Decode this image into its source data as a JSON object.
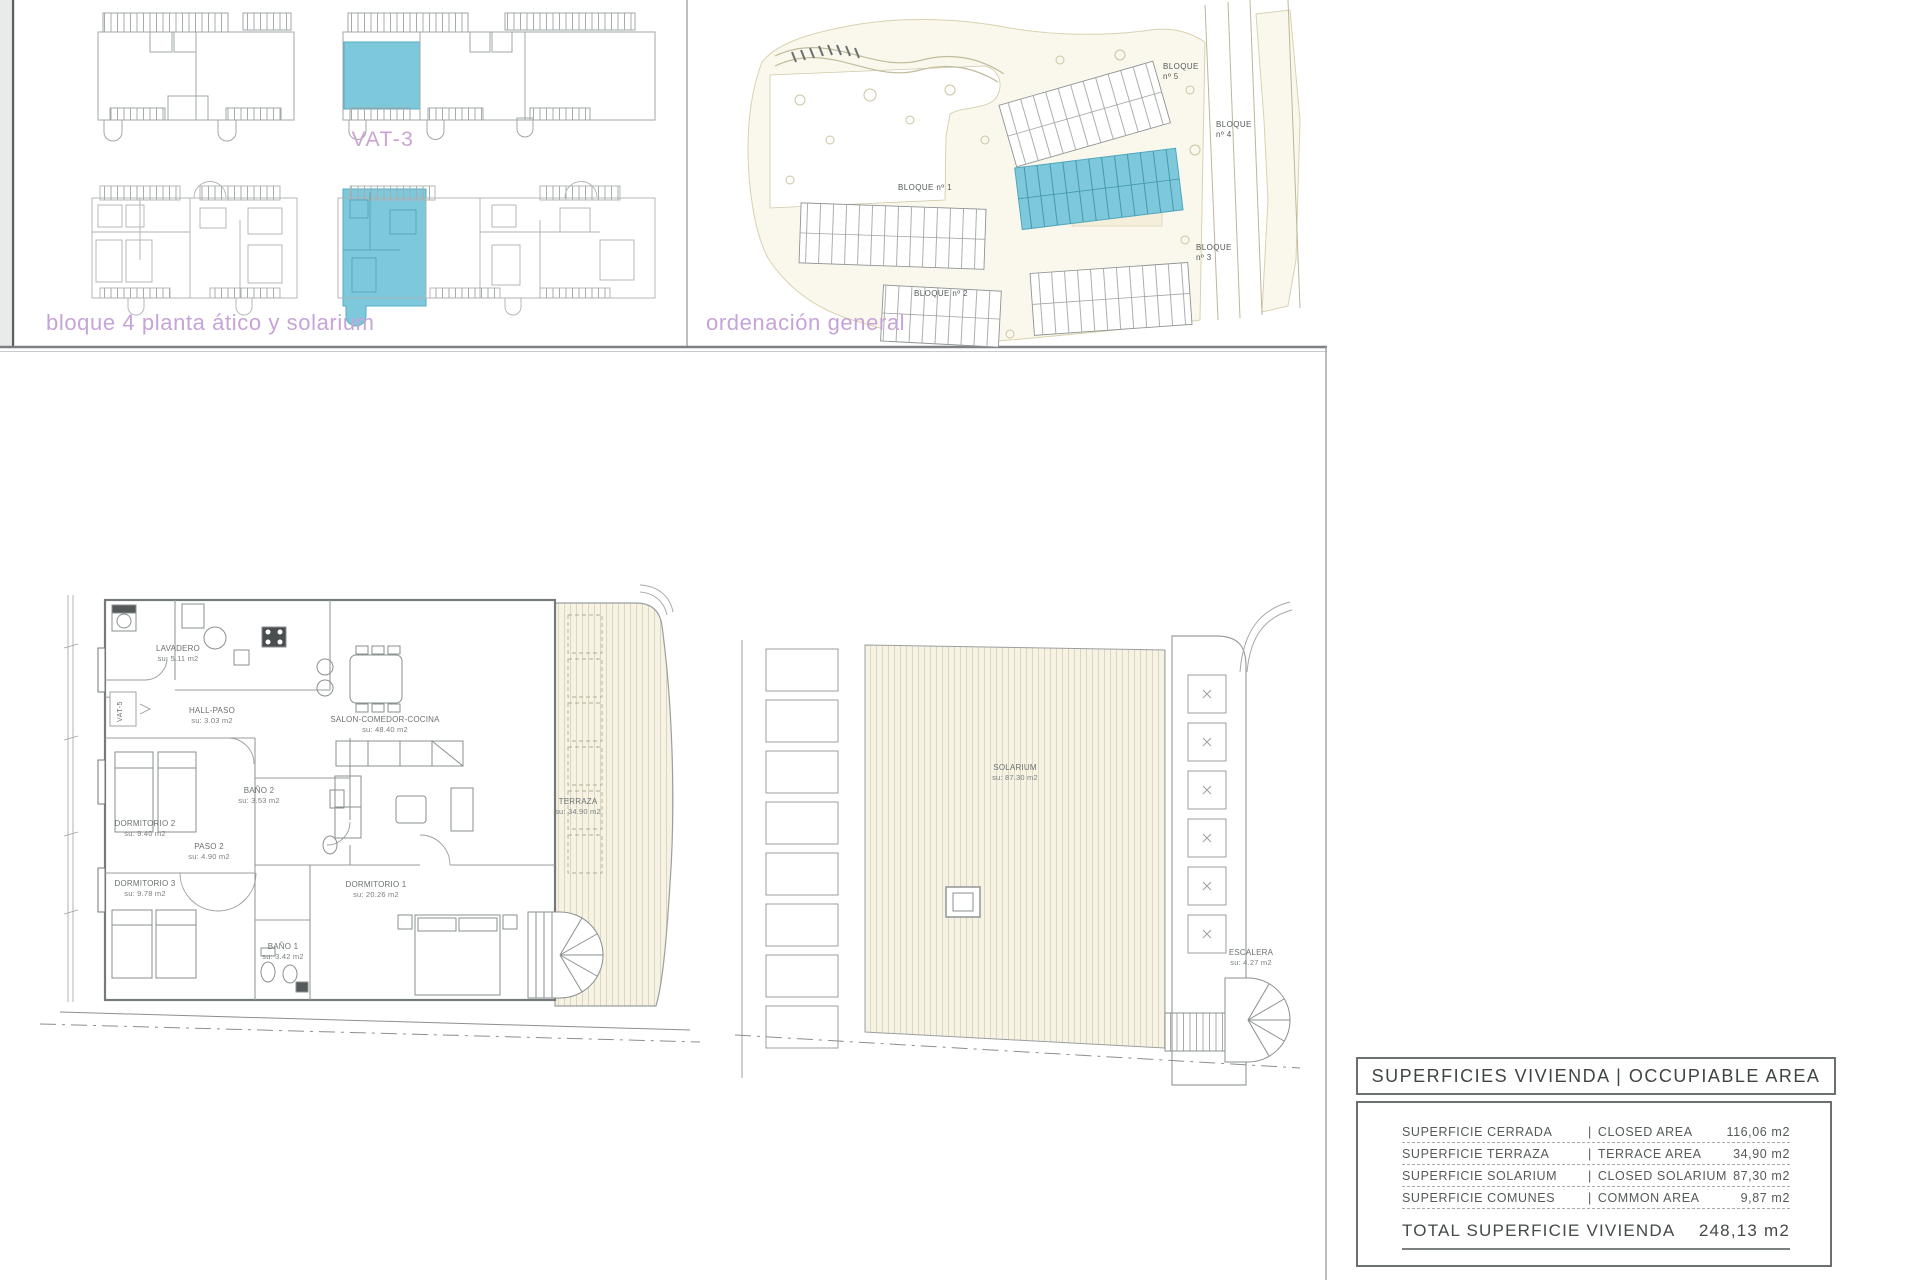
{
  "palette": {
    "highlight_teal": "#7dc8db",
    "teal_stroke": "#4fa6bd",
    "caption_purple": "#c6a4d7",
    "unit_purple": "#cba3d3",
    "line_gray": "#9b9fa0",
    "wall_gray": "#74797a",
    "text_gray": "#6b7071",
    "deck_fill": "#f6f3e5",
    "deck_stripe": "#dbd6bc",
    "site_fill": "#faf8ec",
    "pool_blue": "#a6e1f2"
  },
  "captions": {
    "block_plan": "bloque 4 planta ático y solarium",
    "site_plan": "ordenación general"
  },
  "unit_labels": {
    "vat3": "VAT-3",
    "vat5": "VAT-5"
  },
  "site_plan": {
    "blocks": {
      "b1": "BLOQUE nº 1",
      "b2": "BLOQUE nº 2",
      "b3": "BLOQUE\nnº 3",
      "b4": "BLOQUE\nnº 4",
      "b5": "BLOQUE\nnº 5"
    }
  },
  "floor_plan": {
    "rooms": {
      "lavadero": {
        "name": "LAVADERO",
        "area": "su: 5.11 m2"
      },
      "hall": {
        "name": "HALL-PASO",
        "area": "su: 3.03 m2"
      },
      "salon": {
        "name": "SALON-COMEDOR-COCINA",
        "area": "su: 48.40 m2"
      },
      "bano2": {
        "name": "BAÑO 2",
        "area": "su: 3.53 m2"
      },
      "dorm2": {
        "name": "DORMITORIO 2",
        "area": "su: 9.40 m2"
      },
      "paso2": {
        "name": "PASO 2",
        "area": "su: 4.90 m2"
      },
      "dorm3": {
        "name": "DORMITORIO 3",
        "area": "su: 9.78 m2"
      },
      "bano1": {
        "name": "BAÑO 1",
        "area": "su: 3.42 m2"
      },
      "dorm1": {
        "name": "DORMITORIO 1",
        "area": "su: 20.26 m2"
      },
      "terraza": {
        "name": "TERRAZA",
        "area": "su: 34.90 m2"
      }
    }
  },
  "solarium_plan": {
    "solarium": {
      "name": "SOLARIUM",
      "area": "su: 87.30 m2"
    },
    "escalera": {
      "name": "ESCALERA",
      "area": "su: 4.27 m2"
    }
  },
  "area_table": {
    "title": "SUPERFICIES VIVIENDA | OCCUPIABLE AREA",
    "separator": "|",
    "rows": [
      {
        "es": "SUPERFICIE CERRADA",
        "en": "CLOSED AREA",
        "value": "116,06 m2"
      },
      {
        "es": "SUPERFICIE TERRAZA",
        "en": "TERRACE AREA",
        "value": "34,90 m2"
      },
      {
        "es": "SUPERFICIE SOLARIUM",
        "en": "CLOSED SOLARIUM",
        "value": "87,30 m2"
      },
      {
        "es": "SUPERFICIE COMUNES",
        "en": "COMMON AREA",
        "value": "9,87 m2"
      }
    ],
    "total": {
      "label": "TOTAL SUPERFICIE VIVIENDA",
      "value": "248,13 m2"
    }
  }
}
